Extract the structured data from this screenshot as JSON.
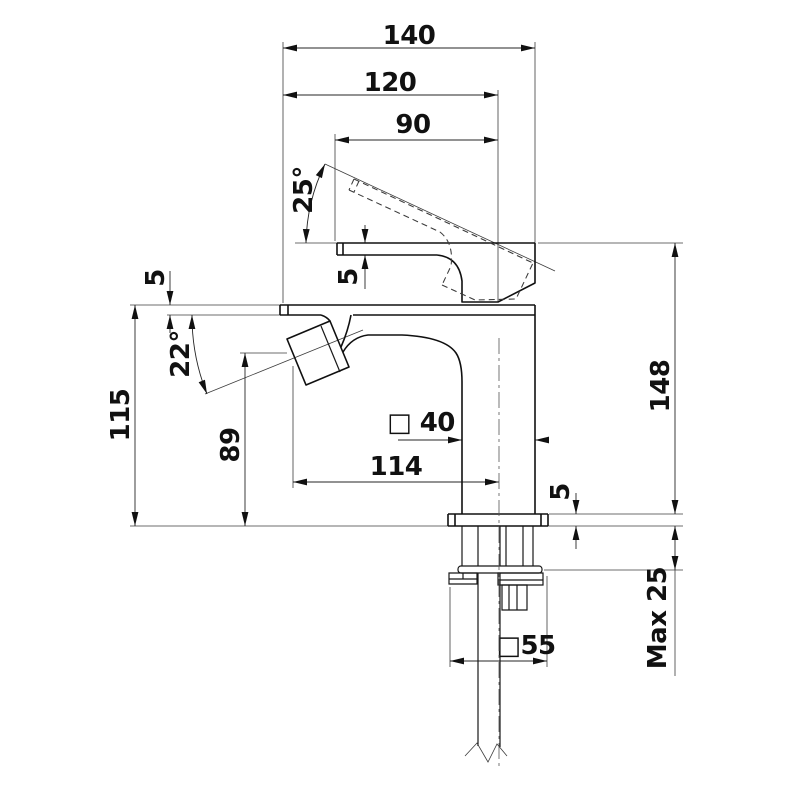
{
  "drawing": {
    "kind": "technical dimension drawing",
    "subject": "single-lever mixer tap, side elevation with mounting hardware",
    "colors": {
      "background": "#ffffff",
      "line": "#101010",
      "dimension": "#262626"
    }
  },
  "dims": {
    "d140": "140",
    "d120": "120",
    "d90": "90",
    "a25": "25°",
    "t5_spout": "5",
    "t5_lip": "5",
    "a22": "22°",
    "h115": "115",
    "h89": "89",
    "h148": "148",
    "sq40": "□ 40",
    "d114": "114",
    "t5_plate": "5",
    "max25": "Max 25",
    "sq55": "□55"
  }
}
